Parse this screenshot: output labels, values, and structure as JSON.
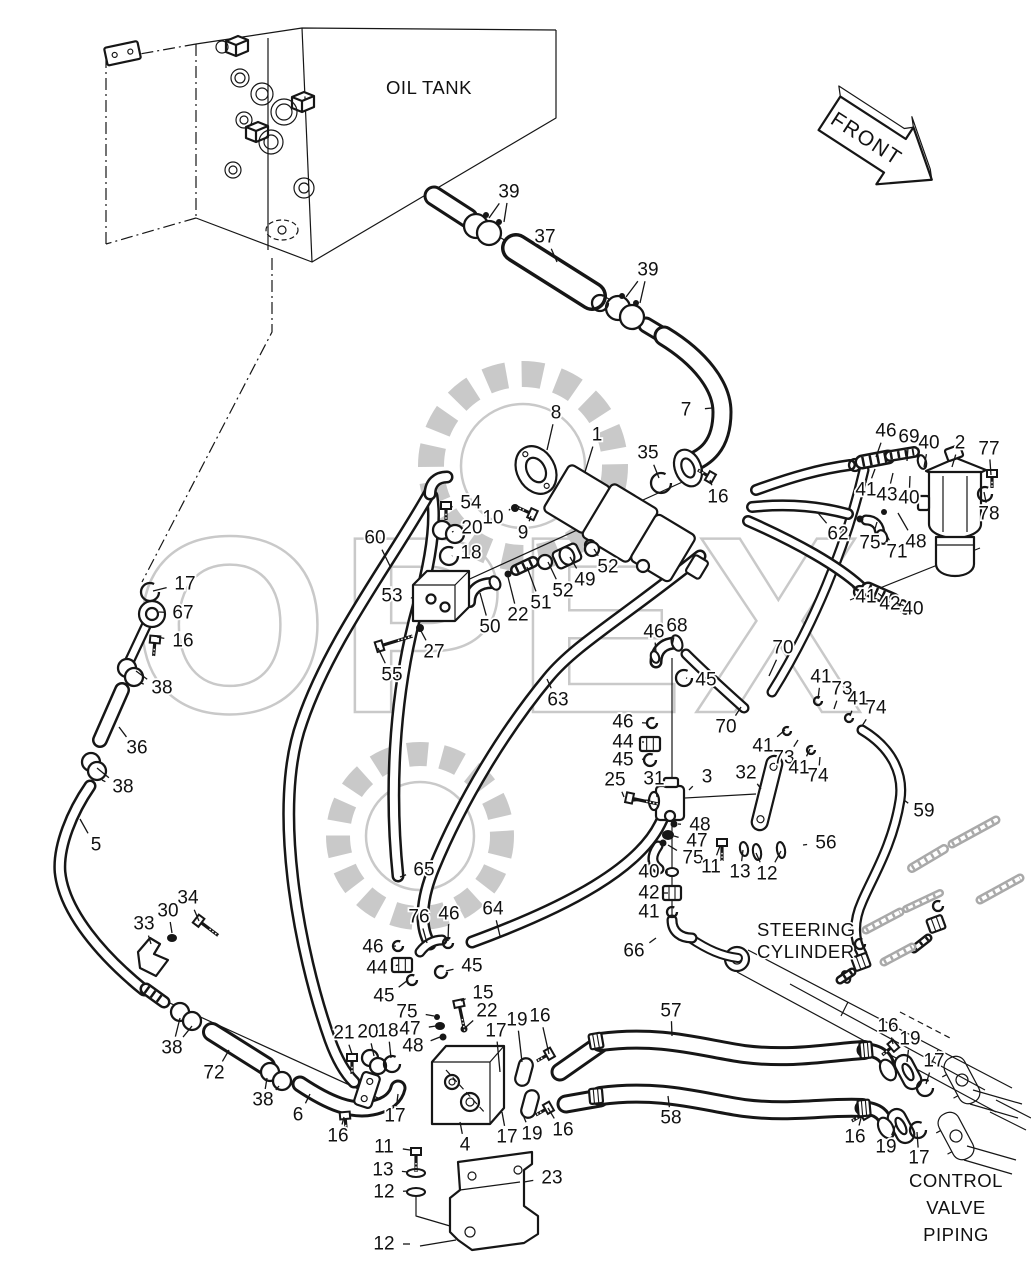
{
  "texts": {
    "oil_tank": "OIL TANK",
    "front": "FRONT",
    "steering_cylinder_line1": "STEERING",
    "steering_cylinder_line2": "CYLINDER",
    "control_valve_line1": "CONTROL",
    "control_valve_line2": "VALVE",
    "control_valve_line3": "PIPING"
  },
  "watermark": {
    "text": "OPEX",
    "color": "#c9c9c9"
  },
  "colors": {
    "line": "#161616",
    "background": "#ffffff",
    "phantom": "#a9a9a9"
  },
  "part_labels": [
    {
      "n": "39",
      "x": 509,
      "y": 192,
      "tx": 489,
      "ty": 218,
      "tx2": 504,
      "ty2": 222
    },
    {
      "n": "37",
      "x": 545,
      "y": 237,
      "tx": 557,
      "ty": 262
    },
    {
      "n": "39",
      "x": 648,
      "y": 270,
      "tx": 626,
      "ty": 297,
      "tx2": 640,
      "ty2": 303
    },
    {
      "n": "7",
      "x": 686,
      "y": 410,
      "tx": 712,
      "ty": 408
    },
    {
      "n": "8",
      "x": 556,
      "y": 413,
      "tx": 547,
      "ty": 450
    },
    {
      "n": "1",
      "x": 597,
      "y": 435,
      "tx": 585,
      "ty": 472
    },
    {
      "n": "35",
      "x": 648,
      "y": 453,
      "tx": 659,
      "ty": 478
    },
    {
      "n": "16",
      "x": 718,
      "y": 497,
      "tx": 710,
      "ty": 480
    },
    {
      "n": "46",
      "x": 886,
      "y": 431,
      "tx": 876,
      "ty": 457
    },
    {
      "n": "69",
      "x": 909,
      "y": 437,
      "tx": 907,
      "ty": 461
    },
    {
      "n": "40",
      "x": 929,
      "y": 443,
      "tx": 924,
      "ty": 467
    },
    {
      "n": "2",
      "x": 960,
      "y": 443,
      "tx": 952,
      "ty": 467
    },
    {
      "n": "77",
      "x": 989,
      "y": 449,
      "tx": 991,
      "ty": 475
    },
    {
      "n": "41",
      "x": 866,
      "y": 490,
      "tx": 875,
      "ty": 469
    },
    {
      "n": "43",
      "x": 887,
      "y": 495,
      "tx": 893,
      "ty": 473
    },
    {
      "n": "40",
      "x": 909,
      "y": 498,
      "tx": 910,
      "ty": 476
    },
    {
      "n": "78",
      "x": 989,
      "y": 514,
      "tx": 984,
      "ty": 492
    },
    {
      "n": "48",
      "x": 916,
      "y": 542,
      "tx": 898,
      "ty": 513
    },
    {
      "n": "62",
      "x": 838,
      "y": 534,
      "tx": 818,
      "ty": 513
    },
    {
      "n": "75",
      "x": 870,
      "y": 543,
      "tx": 877,
      "ty": 522
    },
    {
      "n": "71",
      "x": 897,
      "y": 552,
      "tx": 884,
      "ty": 530
    },
    {
      "n": "54",
      "x": 471,
      "y": 503,
      "tx": 452,
      "ty": 507
    },
    {
      "n": "10",
      "x": 493,
      "y": 518,
      "tx": 510,
      "ty": 509
    },
    {
      "n": "9",
      "x": 523,
      "y": 533,
      "tx": 531,
      "ty": 516
    },
    {
      "n": "20",
      "x": 472,
      "y": 528,
      "tx": 452,
      "ty": 532
    },
    {
      "n": "18",
      "x": 471,
      "y": 553,
      "tx": 452,
      "ty": 556
    },
    {
      "n": "60",
      "x": 375,
      "y": 538,
      "tx": 390,
      "ty": 566
    },
    {
      "n": "53",
      "x": 392,
      "y": 596,
      "tx": 412,
      "ty": 598
    },
    {
      "n": "52",
      "x": 608,
      "y": 567,
      "tx": 594,
      "ty": 549
    },
    {
      "n": "49",
      "x": 585,
      "y": 580,
      "tx": 570,
      "ty": 557
    },
    {
      "n": "52",
      "x": 563,
      "y": 591,
      "tx": 548,
      "ty": 562
    },
    {
      "n": "51",
      "x": 541,
      "y": 603,
      "tx": 527,
      "ty": 567
    },
    {
      "n": "22",
      "x": 518,
      "y": 615,
      "tx": 508,
      "ty": 577
    },
    {
      "n": "50",
      "x": 490,
      "y": 627,
      "tx": 480,
      "ty": 593
    },
    {
      "n": "27",
      "x": 434,
      "y": 652,
      "tx": 421,
      "ty": 631
    },
    {
      "n": "55",
      "x": 392,
      "y": 675,
      "tx": 378,
      "ty": 648
    },
    {
      "n": "17",
      "x": 185,
      "y": 584,
      "tx": 153,
      "ty": 591
    },
    {
      "n": "67",
      "x": 183,
      "y": 613,
      "tx": 159,
      "ty": 612
    },
    {
      "n": "16",
      "x": 183,
      "y": 641,
      "tx": 157,
      "ty": 637
    },
    {
      "n": "38",
      "x": 162,
      "y": 688,
      "tx": 136,
      "ty": 671,
      "tx2": 141,
      "ty2": 683
    },
    {
      "n": "36",
      "x": 137,
      "y": 748,
      "tx": 119,
      "ty": 727
    },
    {
      "n": "38",
      "x": 123,
      "y": 787,
      "tx": 97,
      "ty": 768,
      "tx2": 102,
      "ty2": 780
    },
    {
      "n": "5",
      "x": 96,
      "y": 845,
      "tx": 80,
      "ty": 819
    },
    {
      "n": "63",
      "x": 558,
      "y": 700,
      "tx": 547,
      "ty": 679
    },
    {
      "n": "46",
      "x": 654,
      "y": 632,
      "tx": 656,
      "ty": 652
    },
    {
      "n": "68",
      "x": 677,
      "y": 626,
      "tx": 672,
      "ty": 646
    },
    {
      "n": "45",
      "x": 706,
      "y": 680,
      "tx": 686,
      "ty": 678
    },
    {
      "n": "70",
      "x": 783,
      "y": 648,
      "tx": 769,
      "ty": 676
    },
    {
      "n": "70",
      "x": 726,
      "y": 727,
      "tx": 741,
      "ty": 707
    },
    {
      "n": "41",
      "x": 821,
      "y": 677,
      "tx": 818,
      "ty": 699
    },
    {
      "n": "73",
      "x": 842,
      "y": 689,
      "tx": 834,
      "ty": 709
    },
    {
      "n": "41",
      "x": 858,
      "y": 699,
      "tx": 850,
      "ty": 716
    },
    {
      "n": "74",
      "x": 876,
      "y": 708,
      "tx": 862,
      "ty": 726
    },
    {
      "n": "41",
      "x": 763,
      "y": 746,
      "tx": 785,
      "ty": 730
    },
    {
      "n": "73",
      "x": 784,
      "y": 758,
      "tx": 798,
      "ty": 740
    },
    {
      "n": "41",
      "x": 799,
      "y": 768,
      "tx": 810,
      "ty": 749
    },
    {
      "n": "74",
      "x": 818,
      "y": 776,
      "tx": 820,
      "ty": 757
    },
    {
      "n": "46",
      "x": 623,
      "y": 722,
      "tx": 646,
      "ty": 723
    },
    {
      "n": "44",
      "x": 623,
      "y": 742,
      "tx": 644,
      "ty": 742
    },
    {
      "n": "45",
      "x": 623,
      "y": 760,
      "tx": 645,
      "ty": 759
    },
    {
      "n": "25",
      "x": 615,
      "y": 780,
      "tx": 624,
      "ty": 797
    },
    {
      "n": "31",
      "x": 654,
      "y": 779,
      "tx": 657,
      "ty": 797
    },
    {
      "n": "3",
      "x": 707,
      "y": 777,
      "tx": 689,
      "ty": 790
    },
    {
      "n": "32",
      "x": 746,
      "y": 773,
      "tx": 761,
      "ty": 789
    },
    {
      "n": "48",
      "x": 700,
      "y": 825,
      "tx": 678,
      "ty": 824
    },
    {
      "n": "47",
      "x": 697,
      "y": 841,
      "tx": 674,
      "ty": 836
    },
    {
      "n": "75",
      "x": 693,
      "y": 858,
      "tx": 668,
      "ty": 845
    },
    {
      "n": "11",
      "x": 711,
      "y": 867,
      "tx": 720,
      "ty": 846
    },
    {
      "n": "13",
      "x": 740,
      "y": 872,
      "tx": 743,
      "ty": 850
    },
    {
      "n": "12",
      "x": 767,
      "y": 874,
      "tx": 756,
      "ty": 853,
      "tx2": 781,
      "ty2": 851
    },
    {
      "n": "56",
      "x": 826,
      "y": 843,
      "tx": 803,
      "ty": 845
    },
    {
      "n": "59",
      "x": 924,
      "y": 811,
      "tx": 904,
      "ty": 800
    },
    {
      "n": "41",
      "x": 866,
      "y": 597,
      "tx": 861,
      "ty": 593
    },
    {
      "n": "42",
      "x": 890,
      "y": 604,
      "tx": 884,
      "ty": 598
    },
    {
      "n": "40",
      "x": 913,
      "y": 609,
      "tx": 905,
      "ty": 606
    },
    {
      "n": "40",
      "x": 649,
      "y": 872,
      "tx": 666,
      "ty": 872
    },
    {
      "n": "42",
      "x": 649,
      "y": 893,
      "tx": 663,
      "ty": 893
    },
    {
      "n": "41",
      "x": 649,
      "y": 912,
      "tx": 666,
      "ty": 912
    },
    {
      "n": "66",
      "x": 634,
      "y": 951,
      "tx": 656,
      "ty": 938
    },
    {
      "n": "65",
      "x": 424,
      "y": 870,
      "tx": 400,
      "ty": 877
    },
    {
      "n": "76",
      "x": 419,
      "y": 917,
      "tx": 427,
      "ty": 943
    },
    {
      "n": "46",
      "x": 449,
      "y": 914,
      "tx": 448,
      "ty": 941
    },
    {
      "n": "64",
      "x": 493,
      "y": 909,
      "tx": 500,
      "ty": 936
    },
    {
      "n": "46",
      "x": 373,
      "y": 947,
      "tx": 396,
      "ty": 946
    },
    {
      "n": "44",
      "x": 377,
      "y": 968,
      "tx": 398,
      "ty": 965
    },
    {
      "n": "45",
      "x": 472,
      "y": 966,
      "tx": 446,
      "ty": 971
    },
    {
      "n": "45",
      "x": 384,
      "y": 996,
      "tx": 408,
      "ty": 980
    },
    {
      "n": "15",
      "x": 483,
      "y": 993,
      "tx": 461,
      "ty": 1001
    },
    {
      "n": "75",
      "x": 407,
      "y": 1012,
      "tx": 434,
      "ty": 1016
    },
    {
      "n": "22",
      "x": 487,
      "y": 1011,
      "tx": 466,
      "ty": 1027
    },
    {
      "n": "47",
      "x": 410,
      "y": 1029,
      "tx": 436,
      "ty": 1026
    },
    {
      "n": "48",
      "x": 413,
      "y": 1046,
      "tx": 440,
      "ty": 1037
    },
    {
      "n": "30",
      "x": 168,
      "y": 911,
      "tx": 172,
      "ty": 933
    },
    {
      "n": "34",
      "x": 188,
      "y": 898,
      "tx": 199,
      "ty": 921
    },
    {
      "n": "33",
      "x": 144,
      "y": 924,
      "tx": 151,
      "ty": 944
    },
    {
      "n": "38",
      "x": 172,
      "y": 1048,
      "tx": 180,
      "ty": 1018,
      "tx2": 192,
      "ty2": 1026
    },
    {
      "n": "72",
      "x": 214,
      "y": 1073,
      "tx": 229,
      "ty": 1050
    },
    {
      "n": "38",
      "x": 263,
      "y": 1100,
      "tx": 267,
      "ty": 1078,
      "tx2": 279,
      "ty2": 1086
    },
    {
      "n": "6",
      "x": 298,
      "y": 1115,
      "tx": 310,
      "ty": 1094
    },
    {
      "n": "16",
      "x": 338,
      "y": 1136,
      "tx": 344,
      "ty": 1117
    },
    {
      "n": "21",
      "x": 344,
      "y": 1033,
      "tx": 352,
      "ty": 1054
    },
    {
      "n": "20",
      "x": 368,
      "y": 1032,
      "tx": 374,
      "ty": 1056
    },
    {
      "n": "18",
      "x": 388,
      "y": 1031,
      "tx": 391,
      "ty": 1058
    },
    {
      "n": "17",
      "x": 395,
      "y": 1116,
      "tx": 398,
      "ty": 1094
    },
    {
      "n": "11",
      "x": 384,
      "y": 1147,
      "tx": 410,
      "ty": 1150
    },
    {
      "n": "13",
      "x": 383,
      "y": 1170,
      "tx": 408,
      "ty": 1172
    },
    {
      "n": "12",
      "x": 384,
      "y": 1192,
      "tx": 408,
      "ty": 1191
    },
    {
      "n": "12",
      "x": 384,
      "y": 1244,
      "tx": 410,
      "ty": 1244
    },
    {
      "n": "4",
      "x": 465,
      "y": 1145,
      "tx": 460,
      "ty": 1122
    },
    {
      "n": "23",
      "x": 552,
      "y": 1178,
      "tx": 524,
      "ty": 1182
    },
    {
      "n": "17",
      "x": 496,
      "y": 1031,
      "tx": 500,
      "ty": 1072
    },
    {
      "n": "19",
      "x": 517,
      "y": 1020,
      "tx": 522,
      "ty": 1062
    },
    {
      "n": "16",
      "x": 540,
      "y": 1016,
      "tx": 549,
      "ty": 1054
    },
    {
      "n": "17",
      "x": 507,
      "y": 1137,
      "tx": 502,
      "ty": 1112
    },
    {
      "n": "19",
      "x": 532,
      "y": 1134,
      "tx": 521,
      "ty": 1110
    },
    {
      "n": "16",
      "x": 563,
      "y": 1130,
      "tx": 548,
      "ty": 1108
    },
    {
      "n": "57",
      "x": 671,
      "y": 1011,
      "tx": 672,
      "ty": 1036
    },
    {
      "n": "58",
      "x": 671,
      "y": 1118,
      "tx": 668,
      "ty": 1096
    },
    {
      "n": "16",
      "x": 888,
      "y": 1026,
      "tx": 893,
      "ty": 1044
    },
    {
      "n": "19",
      "x": 910,
      "y": 1039,
      "tx": 907,
      "ty": 1062
    },
    {
      "n": "17",
      "x": 934,
      "y": 1061,
      "tx": 926,
      "ty": 1084
    },
    {
      "n": "16",
      "x": 855,
      "y": 1137,
      "tx": 861,
      "ty": 1118
    },
    {
      "n": "19",
      "x": 886,
      "y": 1147,
      "tx": 896,
      "ty": 1124
    },
    {
      "n": "17",
      "x": 919,
      "y": 1158,
      "tx": 917,
      "ty": 1132
    }
  ]
}
